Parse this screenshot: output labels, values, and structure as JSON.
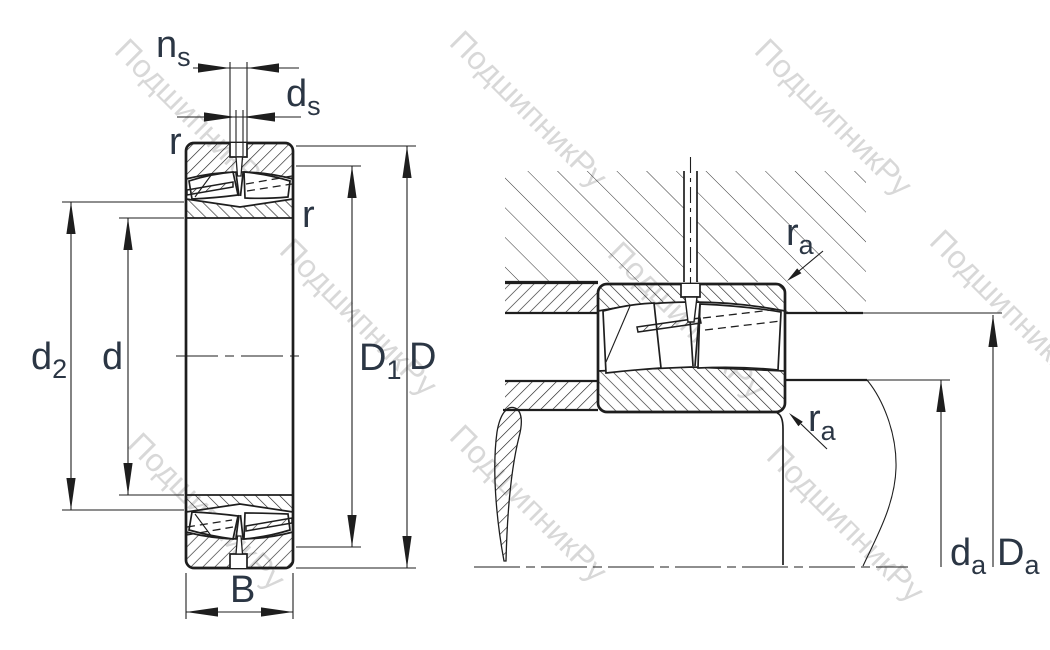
{
  "drawing": {
    "type": "bearing-technical-drawing",
    "line_color": "#1e1e1e",
    "label_color": "#2b3644"
  },
  "watermark": {
    "text": "ПодшипникРу",
    "color": "#b9b9b9"
  },
  "left_view": {
    "description": "spherical-roller-bearing-cross-section",
    "labels": {
      "ns": {
        "main": "n",
        "sub": "s"
      },
      "ds": {
        "main": "d",
        "sub": "s"
      },
      "r_top": {
        "main": "r"
      },
      "r_side": {
        "main": "r"
      },
      "d2": {
        "main": "d",
        "sub": "2"
      },
      "d": {
        "main": "d"
      },
      "D1": {
        "main": "D",
        "sub": "1"
      },
      "D": {
        "main": "D"
      },
      "B": {
        "main": "B"
      }
    }
  },
  "right_view": {
    "description": "mounted-bearing-in-housing-on-shaft",
    "labels": {
      "ra_top": {
        "main": "r",
        "sub": "a"
      },
      "ra_bottom": {
        "main": "r",
        "sub": "a"
      },
      "da": {
        "main": "d",
        "sub": "a"
      },
      "Da": {
        "main": "D",
        "sub": "a"
      }
    }
  }
}
